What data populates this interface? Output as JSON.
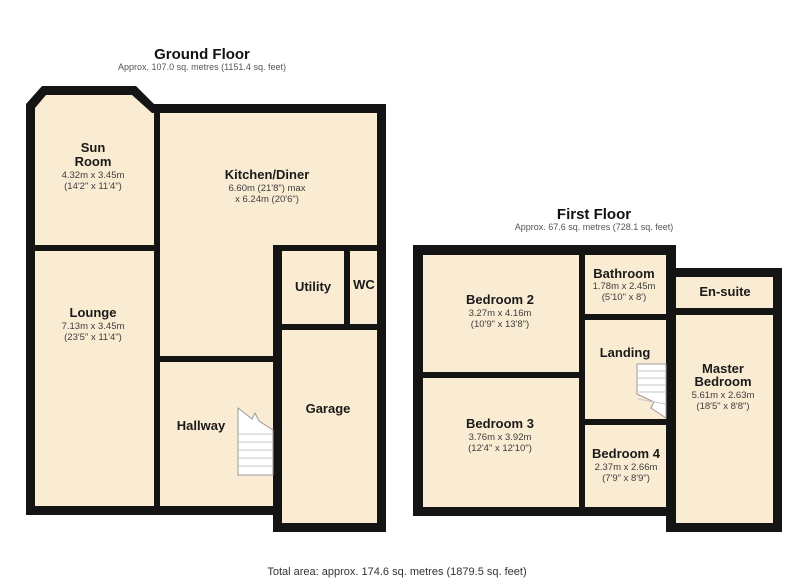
{
  "page": {
    "total_area_label": "Total area: approx. 174.6 sq. metres (1879.5 sq. feet)"
  },
  "colors": {
    "room_fill": "#FAEBD3",
    "wall": "#141414",
    "stairs_fill": "#ffffff",
    "stairs_step_line": "#c6c6c6",
    "room_name_text": "#1a1a1a",
    "dims_text": "#3d3d3d",
    "subtitle_text": "#555555",
    "background": "#ffffff"
  },
  "ground_floor": {
    "title": "Ground Floor",
    "subtitle": "Approx. 107.0 sq. metres (1151.4 sq. feet)",
    "rooms": {
      "sun_room": {
        "name": "Sun Room",
        "name_l1": "Sun",
        "name_l2": "Room",
        "dims_m": "4.32m x 3.45m",
        "dims_ft": "(14'2\" x 11'4\")"
      },
      "kitchen_diner": {
        "name": "Kitchen/Diner",
        "dims_m": "6.60m (21'8\") max",
        "dims_ft": "x 6.24m (20'6\")"
      },
      "lounge": {
        "name": "Lounge",
        "dims_m": "7.13m x 3.45m",
        "dims_ft": "(23'5\" x 11'4\")"
      },
      "utility": {
        "name": "Utility"
      },
      "wc": {
        "name": "WC"
      },
      "hallway": {
        "name": "Hallway"
      },
      "garage": {
        "name": "Garage"
      }
    }
  },
  "first_floor": {
    "title": "First Floor",
    "subtitle": "Approx. 67.6 sq. metres (728.1 sq. feet)",
    "rooms": {
      "bedroom2": {
        "name": "Bedroom 2",
        "dims_m": "3.27m x 4.16m",
        "dims_ft": "(10'9\" x 13'8\")"
      },
      "bathroom": {
        "name": "Bathroom",
        "dims_m": "1.78m x 2.45m",
        "dims_ft": "(5'10\" x 8')"
      },
      "ensuite": {
        "name": "En-suite"
      },
      "landing": {
        "name": "Landing"
      },
      "master_bedroom": {
        "name": "Master Bedroom",
        "name_l1": "Master",
        "name_l2": "Bedroom",
        "dims_m": "5.61m x 2.63m",
        "dims_ft": "(18'5\" x 8'8\")"
      },
      "bedroom3": {
        "name": "Bedroom 3",
        "dims_m": "3.76m x 3.92m",
        "dims_ft": "(12'4\" x 12'10\")"
      },
      "bedroom4": {
        "name": "Bedroom 4",
        "dims_m": "2.37m x 2.66m",
        "dims_ft": "(7'9\" x 8'9\")"
      }
    }
  }
}
